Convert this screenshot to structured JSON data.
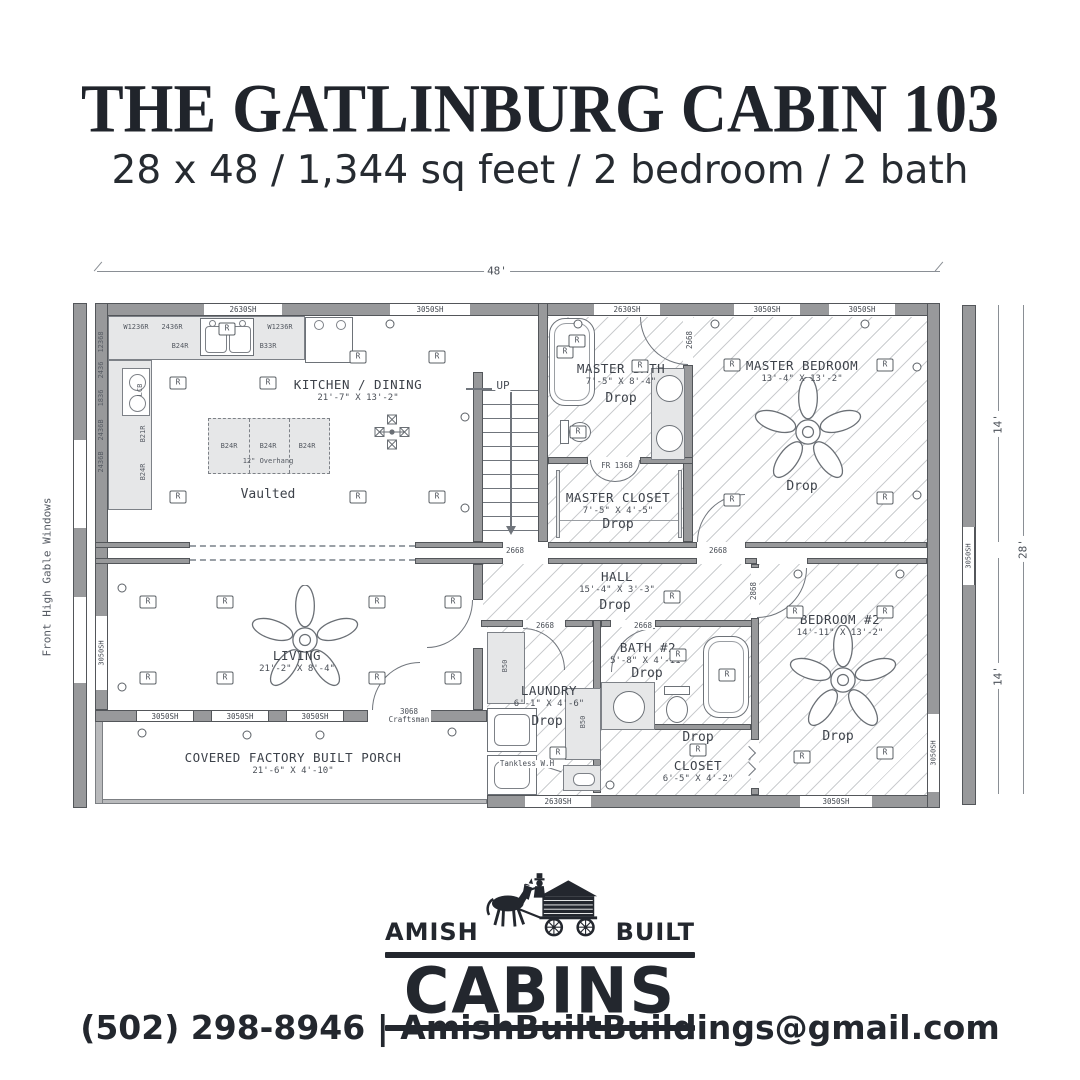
{
  "header": {
    "title": "THE GATLINBURG CABIN 103",
    "subtitle": "28 x 48 / 1,344 sq feet / 2 bedroom / 2 bath"
  },
  "plan": {
    "dimensions": {
      "top": "48'",
      "right_upper": "14'",
      "right_lower": "14'",
      "right_total": "28'"
    },
    "side_note": "Front High Gable Windows",
    "rooms": {
      "kitchen": {
        "name": "KITCHEN / DINING",
        "dims": "21'-7\" X 13'-2\"",
        "note": "Vaulted"
      },
      "master_bath": {
        "name": "MASTER BATH",
        "dims": "7'-5\" X 8'-4\"",
        "note": "Drop"
      },
      "master_closet": {
        "name": "MASTER CLOSET",
        "dims": "7'-5\" X 4'-5\"",
        "note": "Drop"
      },
      "master_bedroom": {
        "name": "MASTER BEDROOM",
        "dims": "13'-4\" X 13'-2\"",
        "note": "Drop"
      },
      "living": {
        "name": "LIVING",
        "dims": "21'-2\" X 8'-4\""
      },
      "hall": {
        "name": "HALL",
        "dims": "15'-4\" X 3'-3\"",
        "note": "Drop"
      },
      "laundry": {
        "name": "LAUNDRY",
        "dims": "6'-1\" X 4'-6\"",
        "note": "Drop"
      },
      "bath2": {
        "name": "BATH #2",
        "dims": "5'-8\" X 4'-11\"",
        "note": "Drop"
      },
      "closet2": {
        "name": "CLOSET",
        "dims": "6'-5\" X 4'-2\"",
        "note": "Drop"
      },
      "bedroom2": {
        "name": "BEDROOM #2",
        "dims": "14'-11\" X 13'-2\"",
        "note": "Drop"
      },
      "porch": {
        "name": "COVERED FACTORY BUILT PORCH",
        "dims": "21'-6\" X 4'-10\""
      }
    },
    "labels": {
      "up": "UP",
      "receptacle": "R",
      "tankless": "Tankless W.H",
      "overhang": "12\" Overhang",
      "craftsman_door": "3068 Craftsman",
      "closet_door": "FR 1368",
      "door_small": "2668",
      "door_large": "2868",
      "window_small": "2630SH",
      "window_large": "3050SH",
      "cab_w1236r": "W1236R",
      "cab_2436r": "2436R",
      "cab_b24r": "B24R",
      "cab_b33r": "B33R",
      "cab_b21r": "B21R",
      "cab_lcb": "LCB",
      "cab_b50": "B50",
      "cab_12368": "12368",
      "cab_2436": "2436",
      "cab_1836": "1836",
      "cab_2436b": "2436B"
    }
  },
  "logo": {
    "word_left": "AMISH",
    "word_right": "BUILT",
    "word_main": "CABINS"
  },
  "footer": {
    "contact_phone": "(502) 298-8946",
    "separator": "|",
    "contact_email": "AmishBuiltBuildings@gmail.com"
  }
}
